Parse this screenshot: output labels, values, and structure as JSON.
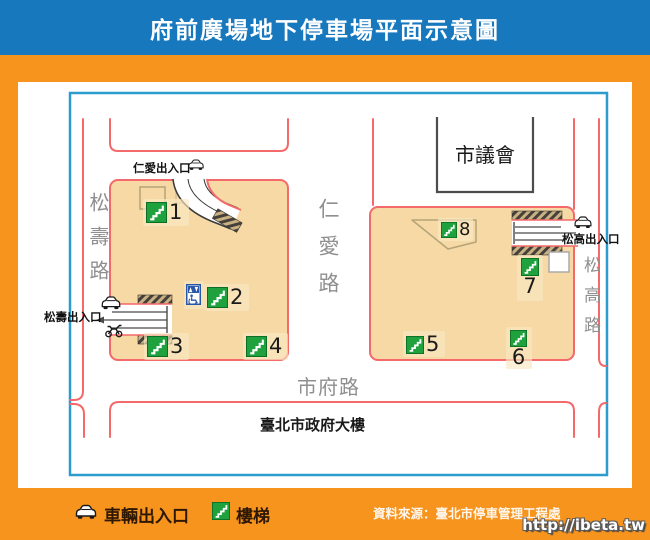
{
  "title": "府前廣場地下停車場平面示意圖",
  "map": {
    "roads": {
      "songshou": "松壽路",
      "renai": "仁愛路",
      "songgao": "松高路",
      "shifu": "市府路"
    },
    "buildings": {
      "city_council": "市議會",
      "city_hall": "臺北市政府大樓"
    },
    "entrances": {
      "renai": "仁愛出入口",
      "songshou": "松壽出入口",
      "songgao": "松高出入口"
    },
    "stairs": [
      "1",
      "2",
      "3",
      "4",
      "5",
      "6",
      "7",
      "8"
    ]
  },
  "legend": {
    "vehicle_label": "車輛出入口",
    "stairs_label": "樓梯",
    "source": "資料來源：臺北市停車管理工程處"
  },
  "watermark": "http://ibeta.tw",
  "icons": {
    "vehicle": "car-icon",
    "motorcycle": "motorcycle-icon",
    "stairs": "stairs-icon",
    "elevator": "elevator-accessible-icon"
  },
  "colors": {
    "header_blue": "#1878BE",
    "frame_orange": "#F7941E",
    "map_border_blue": "#2B9CCE",
    "parking_fill_tan": "#F6D9A4",
    "street_line_red": "#F4696A",
    "stairs_green": "#1FA23D",
    "elevator_blue": "#2A57A8"
  }
}
